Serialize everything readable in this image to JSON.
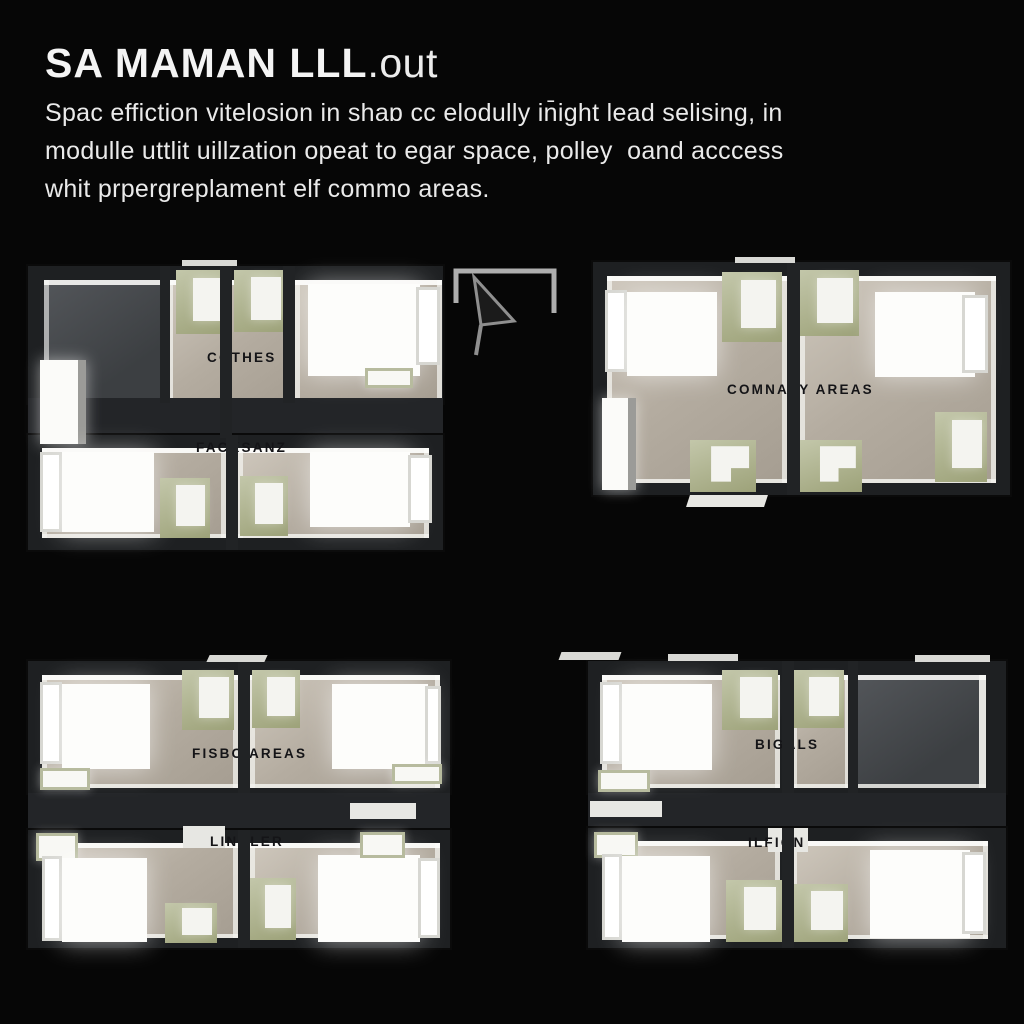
{
  "header": {
    "title_main": "SA MAMAN LLL",
    "title_suffix": ".out",
    "description_lines": [
      "Spac effiction vitelosion in shaɒ cc elodully in̄ight lead selising, in",
      "modulle uttlit uillzation opeat to egar space, polley  oand acccess",
      "whit prpergreplament elf commo areas."
    ]
  },
  "floorplan": {
    "labels": {
      "top_left_upper": "COTHES",
      "top_left_lower": "FACKSANZ",
      "top_right": "COMNAVY AREAS",
      "bottom_left_upper": "FISBC AREAS",
      "bottom_left_lower": "LINALER",
      "bottom_right_upper": "BIGALS",
      "bottom_right_lower": "ILFIGN"
    },
    "colors": {
      "background": "#060606",
      "title_text": "#f4f4f4",
      "wall_dark": "#1e2022",
      "floor_beige": "#b4aca0",
      "floor_dark": "#3c3f42",
      "furniture_green": "#a7ab8c",
      "bed_white": "#fdfdfb",
      "label_text": "#141417",
      "wall_rim_white": "#f2f2ee"
    },
    "icons": [
      "north-arrow-icon"
    ]
  }
}
